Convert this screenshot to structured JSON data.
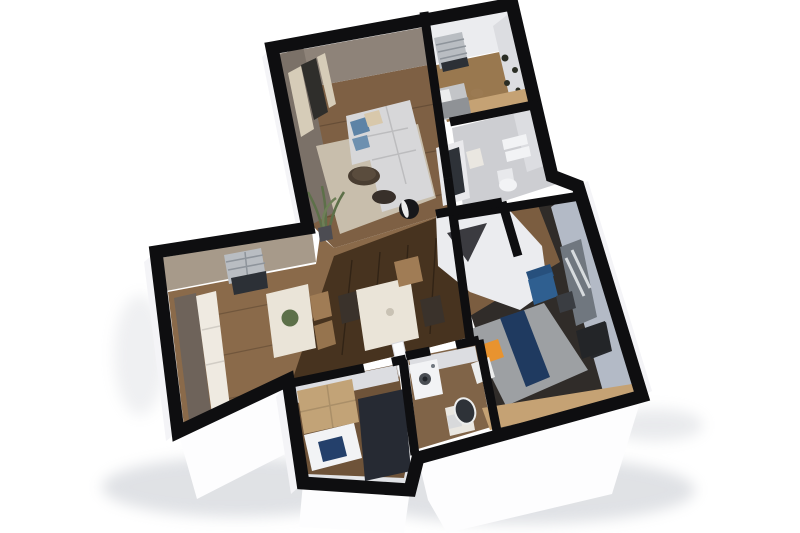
{
  "scene": {
    "kind": "3d-floor-plan-render",
    "rooms": [
      "living-room",
      "bedroom-top",
      "bathroom-top",
      "kitchen-dining",
      "hallway",
      "small-bedroom",
      "laundry-bathroom",
      "master-bedroom"
    ]
  },
  "palette": {
    "bg": "#ffffff",
    "wall": "#0e0e10",
    "ext1": "#fdfdfe",
    "ext2": "#f4f4f7",
    "ext3": "#e9e9ee",
    "shadow": "#b9bec6",
    "faceTaupe": "#8e8379",
    "faceTaupeDark": "#7b7168",
    "faceKitchen": "#a79a8a",
    "faceWhite": "#ebecef",
    "faceWhiteDim": "#dcdde1",
    "faceBlue": "#b3bac6",
    "curtain": "#d6ccb8",
    "doorDark": "#2f2e2b",
    "windowBlind": "#b9bdc2",
    "windowDark": "#2c3036",
    "windowGray": "#70777f",
    "radiatorDark": "#26282c",
    "floorLiving": "#7e6044",
    "floorKitchen": "#8a6a4a",
    "floorDark": "#47331f",
    "floorSmallBed": "#6e5339",
    "floorBath2": "#806448",
    "floorBed1": "#99784f",
    "floorBath1": "#cdced2",
    "floorBed2": "#302c29",
    "floorCloset": "#7b5d40",
    "rugLiving": "#c8beac",
    "sofa": "#d7d7d9",
    "pillowBlue": "#5d83a6",
    "pillowBlue2": "#6d90b0",
    "pillowBeige": "#d8c8ab",
    "tableDark": "#493d31",
    "tableDark2": "#38302a",
    "sphereDark": "#17171a",
    "sphereLight": "#ececec",
    "plantGreen": "#5d7049",
    "plantGreen2": "#6e7f57",
    "plantPot": "#4c4c52",
    "marble": "#eae4d8",
    "chairWood": "#a07c55",
    "chairWood2": "#96744e",
    "chairDark": "#3a322b",
    "cabinetTall": "#6e635a",
    "counterWhite": "#efeae1",
    "deskWood": "#c5a274",
    "bedGray": "#c3c5c8",
    "bed2Gray": "#9da0a3",
    "mattressLight": "#eceded",
    "blanketGray": "#8f9296",
    "navy": "#24406b",
    "navy2": "#1f3a60",
    "orange": "#e8932f",
    "wardrobeWood": "#c2a377",
    "wardrobeDark": "#262a33",
    "fixtureWhite": "#f2f3f5",
    "fixtureWhite2": "#e8e9ec",
    "sinkBeige": "#eae7e1",
    "towelGray": "#d8d9db",
    "mirrorDark": "#2e3238",
    "mirrorFrame": "#e9e9ec",
    "armchairBlue": "#2f5f90",
    "armchairBlueDark": "#27507d",
    "tvDark": "#232528",
    "notchDark": "#3b3b40",
    "washerDoor": "#4a4e54",
    "washerDoorIn": "#22252a",
    "artDark": "#2a2d24",
    "stoolWood": "#9b7a52",
    "tabletop2": "#5a4c3d",
    "vase": "#c9c2b4",
    "nightstand": "#3a3d42",
    "doorLeaf": "#fafbfc"
  }
}
